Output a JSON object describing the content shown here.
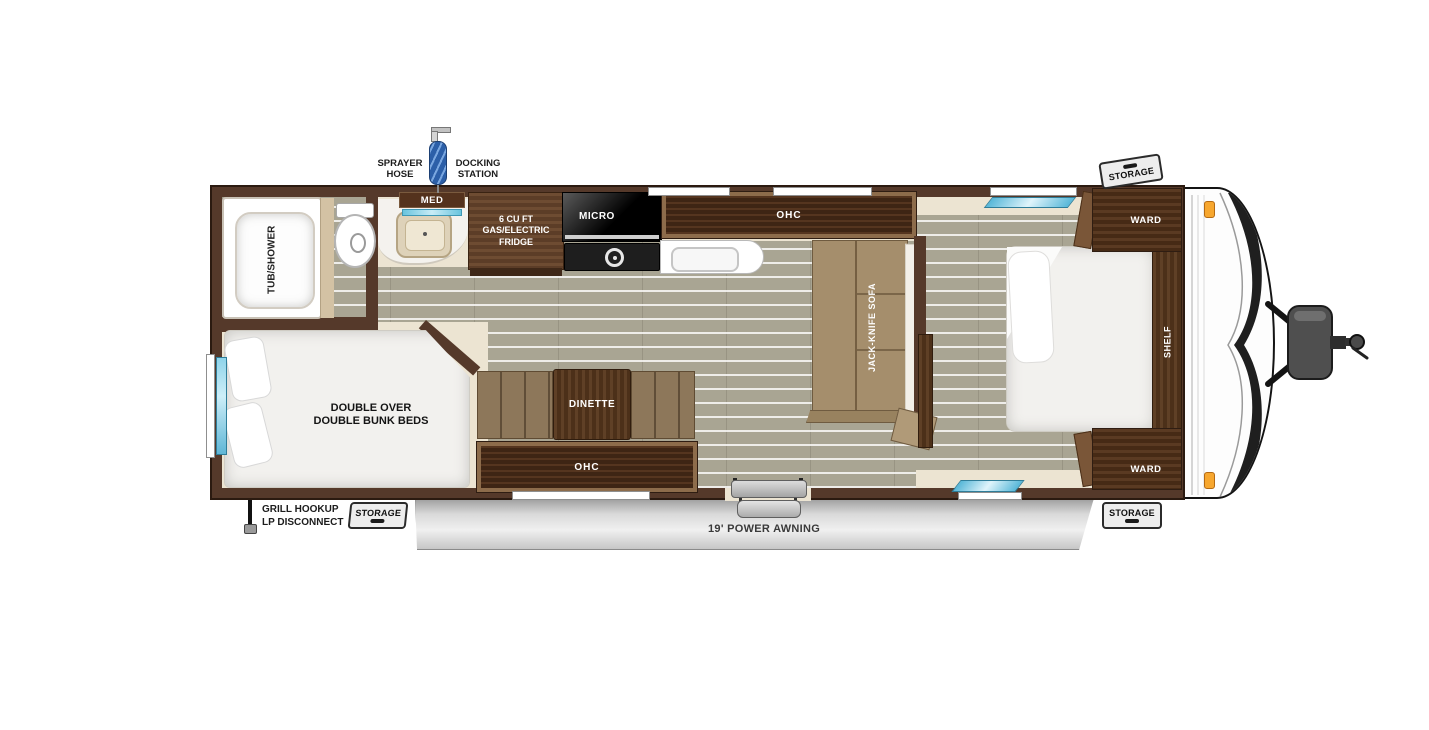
{
  "plan": {
    "exterior": {
      "sprayer_hose": "SPRAYER\nHOSE",
      "docking_station": "DOCKING\nSTATION",
      "storage_top": "STORAGE",
      "storage_bottom_left": "STORAGE",
      "storage_bottom_right": "STORAGE",
      "awning": "19' POWER AWNING",
      "grill_hookup": "GRILL HOOKUP\nLP DISCONNECT"
    },
    "bathroom": {
      "tub_shower": "TUB/SHOWER",
      "med_cabinet": "MED"
    },
    "kitchen": {
      "fridge": "6 CU FT\nGAS/ELECTRIC\nFRIDGE",
      "microwave": "MICRO",
      "overhead_cabinet": "OHC"
    },
    "living": {
      "sofa": "JACK-KNIFE SOFA",
      "dinette": "DINETTE",
      "overhead_cabinet": "OHC"
    },
    "bunkroom": {
      "bunks": "DOUBLE OVER\nDOUBLE BUNK BEDS"
    },
    "bedroom": {
      "wardrobe_front": "WARD",
      "wardrobe_rear": "WARD",
      "shelf": "SHELF"
    },
    "colors": {
      "wall": "#55392a",
      "floor": "#a9a593",
      "cream": "#ece4d2",
      "wood": "#6b4a31",
      "window_blue": "#7ccbe4",
      "awning": "#d6d6d6",
      "sofa": "#a58e6c"
    }
  }
}
